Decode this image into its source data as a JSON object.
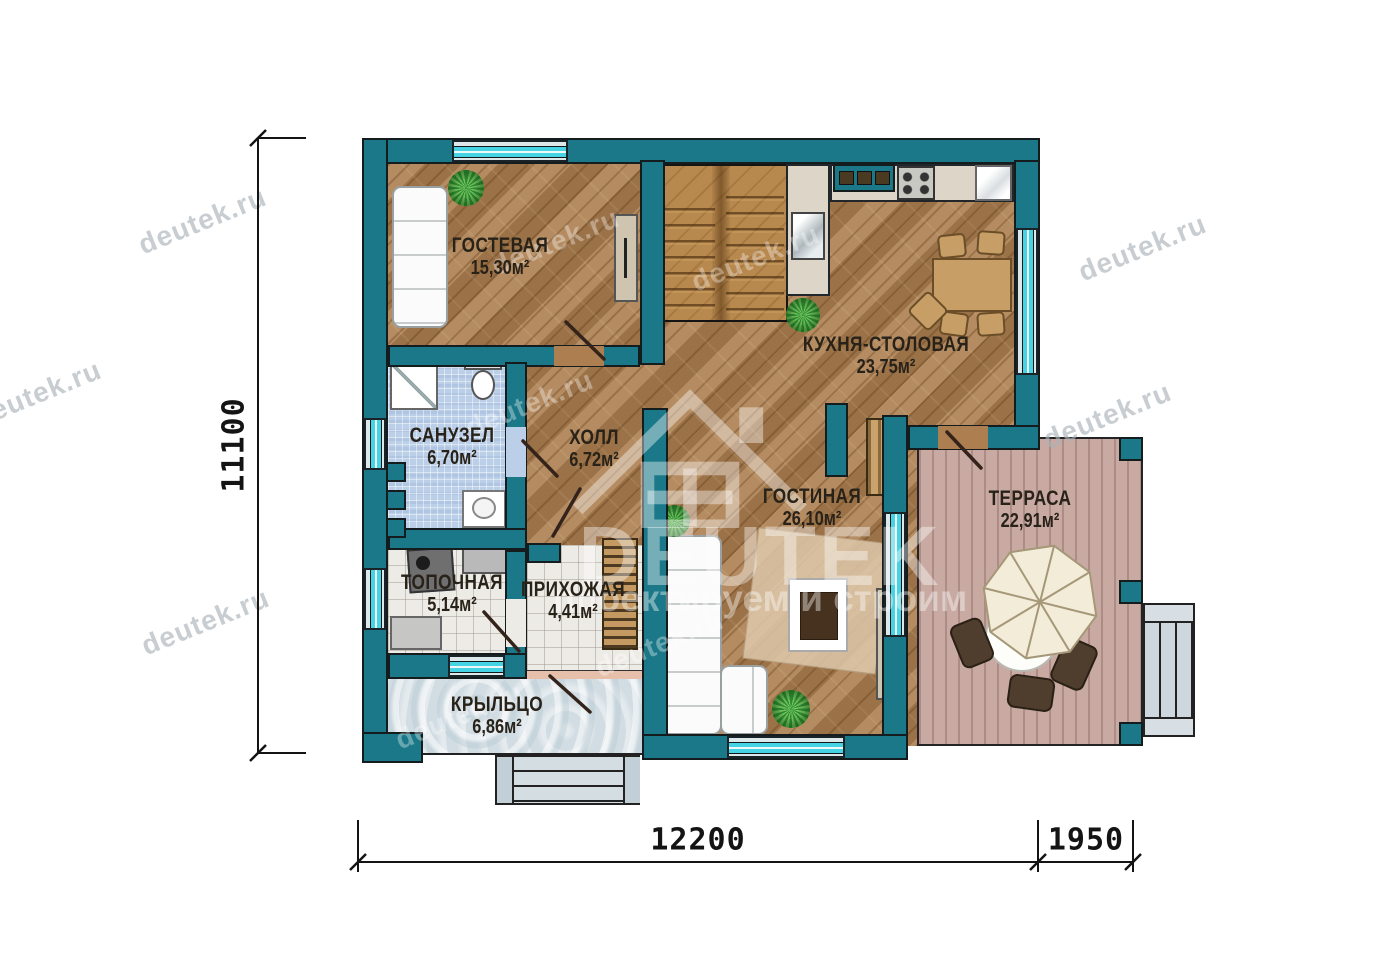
{
  "rooms": {
    "guest": {
      "name": "ГОСТЕВАЯ",
      "area": "15,30м²"
    },
    "kitchen": {
      "name": "КУХНЯ-СТОЛОВАЯ",
      "area": "23,75м²"
    },
    "bathroom": {
      "name": "САНУЗЕЛ",
      "area": "6,70м²"
    },
    "hall": {
      "name": "ХОЛЛ",
      "area": "6,72м²"
    },
    "living": {
      "name": "ГОСТИНАЯ",
      "area": "26,10м²"
    },
    "terrace": {
      "name": "ТЕРРАСА",
      "area": "22,91м²"
    },
    "boiler": {
      "name": "ТОПОЧНАЯ",
      "area": "5,14м²"
    },
    "entry": {
      "name": "ПРИХОЖАЯ",
      "area": "4,41м²"
    },
    "porch": {
      "name": "КРЫЛЬЦО",
      "area": "6,86м²"
    }
  },
  "dimensions": {
    "height": "11100",
    "width_main": "12200",
    "width_terrace": "1950"
  },
  "watermark": {
    "site": "deutek.ru",
    "brand": "DEUTEK",
    "slogan": "проектируем и строим"
  },
  "colors": {
    "wall_teal": "#1a7888",
    "window_glass": "#46d4e4",
    "wood_floor": "#ad7f50",
    "terrace_deck": "#c9aaa2",
    "bath_tile": "#bccfe8"
  }
}
